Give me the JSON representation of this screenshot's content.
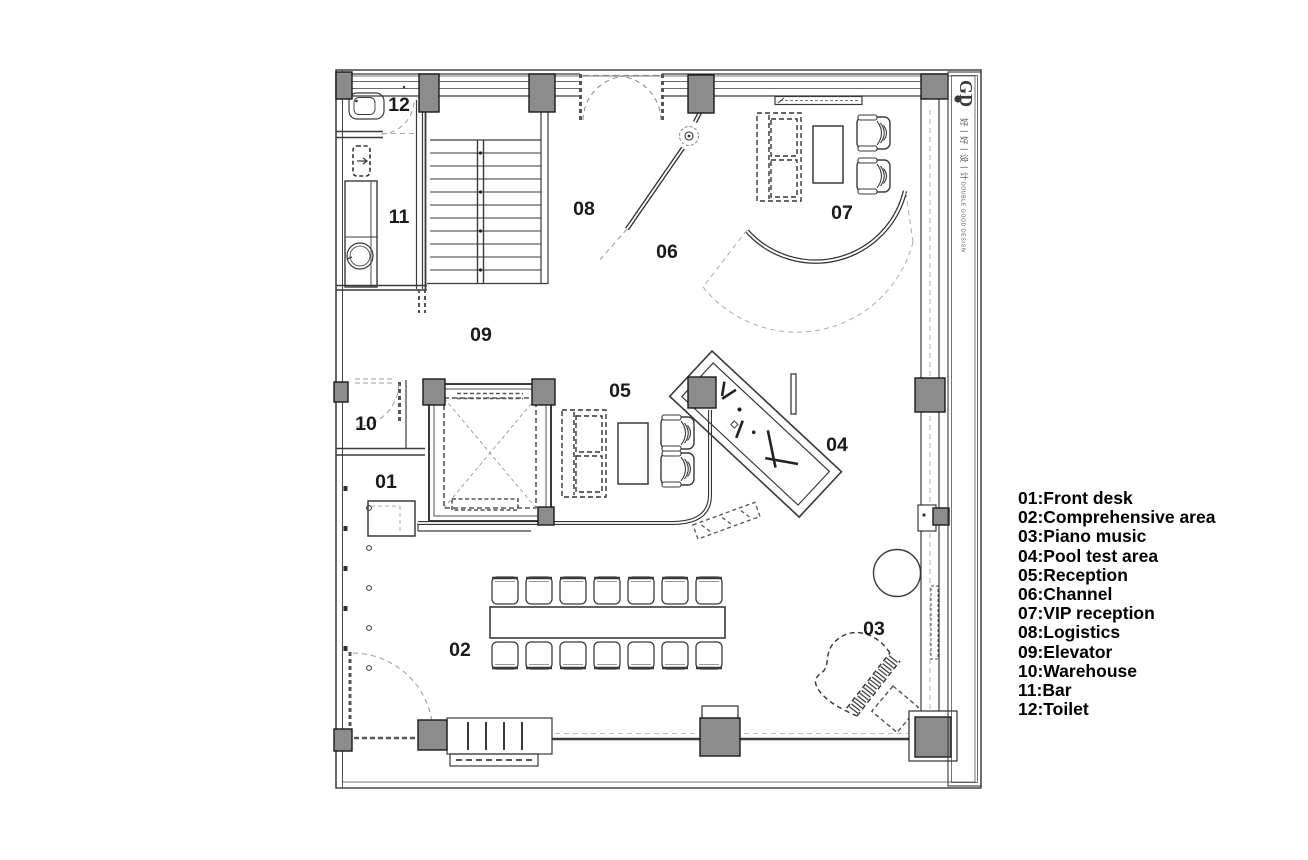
{
  "title_block": {
    "logo": "GD",
    "brand_cn": "好丨好丨设丨计",
    "brand_en": "DOUBLE GOOD DESIGN"
  },
  "plan": {
    "room_labels": [
      "01",
      "02",
      "03",
      "04",
      "05",
      "06",
      "07",
      "08",
      "09",
      "10",
      "11",
      "12"
    ]
  },
  "legend": {
    "items": [
      "01:Front desk",
      "02:Comprehensive area",
      "03:Piano music",
      "04:Pool test area",
      "05:Reception",
      "06:Channel",
      "07:VIP reception",
      "08:Logistics",
      "09:Elevator",
      "10:Warehouse",
      "11:Bar",
      "12:Toilet"
    ]
  }
}
